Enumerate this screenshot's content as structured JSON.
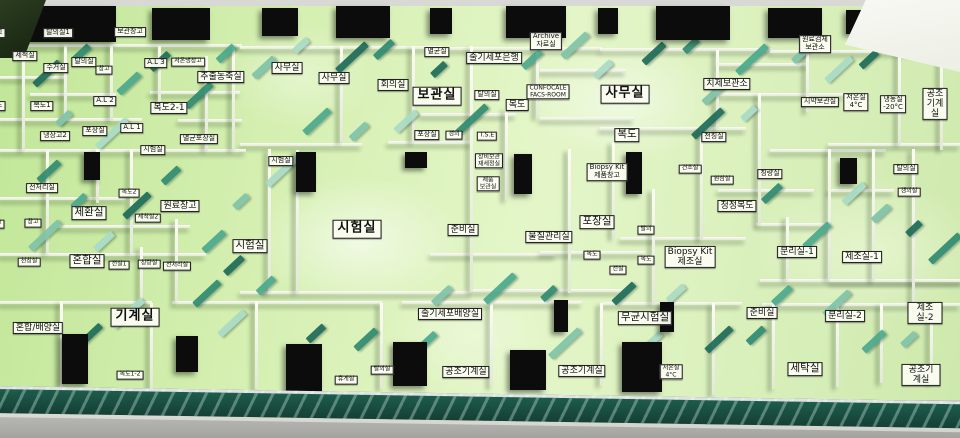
{
  "colors": {
    "floor_green": "#d6f1b2",
    "wall_white": "#f6f8ee",
    "accent_teal_dark": "#1d6b58",
    "accent_teal_light": "#aadbc6",
    "core_black": "#0c0c0c",
    "label_bg": "#f8fbee",
    "label_border": "#1b1b1b",
    "front_edge": "#17493d",
    "table_gray": "#b5b5b1"
  },
  "model": {
    "labels": [
      {
        "text": "탈의실1",
        "x": 58,
        "y": 33,
        "size": "sm"
      },
      {
        "text": "보관창고",
        "x": 130,
        "y": 32,
        "size": "sm"
      },
      {
        "text": "창고",
        "x": -4,
        "y": 33,
        "size": "sm"
      },
      {
        "text": "세척실",
        "x": 25,
        "y": 56,
        "size": "sm"
      },
      {
        "text": "수거실",
        "x": 56,
        "y": 68,
        "size": "sm"
      },
      {
        "text": "탈의실",
        "x": 84,
        "y": 62,
        "size": "sm"
      },
      {
        "text": "창고",
        "x": 104,
        "y": 70,
        "size": "xs"
      },
      {
        "text": "A.L 3",
        "x": 156,
        "y": 63,
        "size": "sm"
      },
      {
        "text": "저온냉장고",
        "x": 188,
        "y": 62,
        "size": "xs"
      },
      {
        "text": "추출농축실",
        "x": 221,
        "y": 77,
        "size": "md"
      },
      {
        "text": "복도1",
        "x": 42,
        "y": 106,
        "size": "sm"
      },
      {
        "text": "복도",
        "x": -4,
        "y": 106,
        "size": "sm"
      },
      {
        "text": "A.L 2",
        "x": 105,
        "y": 101,
        "size": "sm"
      },
      {
        "text": "복도2-1",
        "x": 169,
        "y": 108,
        "size": "md"
      },
      {
        "text": "냉장고2",
        "x": 55,
        "y": 136,
        "size": "sm"
      },
      {
        "text": "포장실",
        "x": 95,
        "y": 131,
        "size": "sm"
      },
      {
        "text": "A.L 1",
        "x": 132,
        "y": 128,
        "size": "sm"
      },
      {
        "text": "멸균포장실",
        "x": 199,
        "y": 139,
        "size": "sm"
      },
      {
        "text": "시험실",
        "x": 153,
        "y": 150,
        "size": "sm"
      },
      {
        "text": "전처리실",
        "x": 42,
        "y": 188,
        "size": "sm"
      },
      {
        "text": "복도2",
        "x": 129,
        "y": 193,
        "size": "xs"
      },
      {
        "text": "제환실",
        "x": 89,
        "y": 213,
        "size": "lg"
      },
      {
        "text": "원료창고",
        "x": 180,
        "y": 206,
        "size": "md"
      },
      {
        "text": "창고",
        "x": 33,
        "y": 223,
        "size": "xs"
      },
      {
        "text": "창고",
        "x": -4,
        "y": 224,
        "size": "xs"
      },
      {
        "text": "세척실2",
        "x": 148,
        "y": 218,
        "size": "xs"
      },
      {
        "text": "천칭실",
        "x": 29,
        "y": 262,
        "size": "xs"
      },
      {
        "text": "혼합실",
        "x": 87,
        "y": 261,
        "size": "lg"
      },
      {
        "text": "전실1",
        "x": 119,
        "y": 265,
        "size": "xs"
      },
      {
        "text": "칭량실",
        "x": 149,
        "y": 264,
        "size": "xs"
      },
      {
        "text": "전처리실",
        "x": 177,
        "y": 266,
        "size": "xs"
      },
      {
        "text": "혼합/배양실",
        "x": 38,
        "y": 328,
        "size": "md"
      },
      {
        "text": "기계실",
        "x": 135,
        "y": 317,
        "size": "xl"
      },
      {
        "text": "복도1-2",
        "x": 130,
        "y": 375,
        "size": "xs"
      },
      {
        "text": "시험실",
        "x": 281,
        "y": 161,
        "size": "sm"
      },
      {
        "text": "시험실",
        "x": 357,
        "y": 229,
        "size": "xl"
      },
      {
        "text": "시험실",
        "x": 250,
        "y": 246,
        "size": "lg"
      },
      {
        "text": "사무실",
        "x": 287,
        "y": 68,
        "size": "md"
      },
      {
        "text": "사무실",
        "x": 334,
        "y": 78,
        "size": "md"
      },
      {
        "text": "회의실",
        "x": 393,
        "y": 85,
        "size": "md"
      },
      {
        "text": "보관실",
        "x": 437,
        "y": 96,
        "size": "xl"
      },
      {
        "text": "멸균실",
        "x": 437,
        "y": 52,
        "size": "sm"
      },
      {
        "text": "포장실",
        "x": 427,
        "y": 135,
        "size": "sm"
      },
      {
        "text": "갱의",
        "x": 454,
        "y": 135,
        "size": "xs"
      },
      {
        "text": "T.S.E",
        "x": 487,
        "y": 136,
        "size": "xs"
      },
      {
        "text": "줄기세포은행",
        "x": 494,
        "y": 58,
        "size": "md"
      },
      {
        "text": "탈의실",
        "x": 487,
        "y": 95,
        "size": "sm"
      },
      {
        "text": "복도",
        "x": 517,
        "y": 105,
        "size": "md"
      },
      {
        "text": "장비보관\n재세정실",
        "x": 489,
        "y": 161,
        "size": "xs"
      },
      {
        "text": "제품\n보관실",
        "x": 488,
        "y": 184,
        "size": "xs"
      },
      {
        "text": "Archive\n자료실",
        "x": 546,
        "y": 41,
        "size": "sm"
      },
      {
        "text": "CONFOCALE\nFACS-ROOM",
        "x": 548,
        "y": 92,
        "size": "xs"
      },
      {
        "text": "사무실",
        "x": 625,
        "y": 94,
        "size": "xl"
      },
      {
        "text": "복도",
        "x": 627,
        "y": 135,
        "size": "lg"
      },
      {
        "text": "준비실",
        "x": 463,
        "y": 230,
        "size": "md"
      },
      {
        "text": "물질관리실",
        "x": 549,
        "y": 237,
        "size": "md"
      },
      {
        "text": "포장실",
        "x": 597,
        "y": 222,
        "size": "lg"
      },
      {
        "text": "Biopsy Kit\n제품창고",
        "x": 607,
        "y": 172,
        "size": "sm"
      },
      {
        "text": "복도",
        "x": 592,
        "y": 255,
        "size": "xs"
      },
      {
        "text": "전실",
        "x": 618,
        "y": 270,
        "size": "xs"
      },
      {
        "text": "줄기세포배양실",
        "x": 450,
        "y": 314,
        "size": "md"
      },
      {
        "text": "무균시험실",
        "x": 645,
        "y": 318,
        "size": "lg"
      },
      {
        "text": "공조기계실",
        "x": 466,
        "y": 372,
        "size": "md"
      },
      {
        "text": "공조기계실",
        "x": 582,
        "y": 371,
        "size": "md"
      },
      {
        "text": "저온실\n4°C",
        "x": 671,
        "y": 372,
        "size": "xs"
      },
      {
        "text": "휴게실",
        "x": 346,
        "y": 380,
        "size": "xs"
      },
      {
        "text": "탈의실",
        "x": 382,
        "y": 370,
        "size": "xs"
      },
      {
        "text": "치제보관소",
        "x": 727,
        "y": 84,
        "size": "md"
      },
      {
        "text": "원료검체\n보관소",
        "x": 815,
        "y": 44,
        "size": "sm"
      },
      {
        "text": "시약보관실",
        "x": 820,
        "y": 102,
        "size": "sm"
      },
      {
        "text": "저온실\n4°C",
        "x": 856,
        "y": 102,
        "size": "sm"
      },
      {
        "text": "냉동실\n-20°C",
        "x": 893,
        "y": 104,
        "size": "sm"
      },
      {
        "text": "공조기계실",
        "x": 935,
        "y": 104,
        "size": "md"
      },
      {
        "text": "천칭실",
        "x": 714,
        "y": 137,
        "size": "sm"
      },
      {
        "text": "건조실",
        "x": 690,
        "y": 169,
        "size": "xs"
      },
      {
        "text": "원심실",
        "x": 722,
        "y": 180,
        "size": "xs"
      },
      {
        "text": "칭량실",
        "x": 770,
        "y": 174,
        "size": "sm"
      },
      {
        "text": "청정복도",
        "x": 737,
        "y": 206,
        "size": "md"
      },
      {
        "text": "탈의",
        "x": 646,
        "y": 230,
        "size": "xs"
      },
      {
        "text": "복도",
        "x": 646,
        "y": 260,
        "size": "xs"
      },
      {
        "text": "Biopsy Kit\n제조실",
        "x": 690,
        "y": 257,
        "size": "md"
      },
      {
        "text": "분리실-1",
        "x": 797,
        "y": 252,
        "size": "md"
      },
      {
        "text": "제조실-1",
        "x": 862,
        "y": 257,
        "size": "md"
      },
      {
        "text": "탈의실",
        "x": 906,
        "y": 169,
        "size": "sm"
      },
      {
        "text": "갱의실",
        "x": 909,
        "y": 192,
        "size": "xs"
      },
      {
        "text": "준비실",
        "x": 762,
        "y": 313,
        "size": "md"
      },
      {
        "text": "분리실-2",
        "x": 845,
        "y": 316,
        "size": "md"
      },
      {
        "text": "제조실-2",
        "x": 925,
        "y": 313,
        "size": "md"
      },
      {
        "text": "세탁실",
        "x": 805,
        "y": 369,
        "size": "lg"
      },
      {
        "text": "공조기계실",
        "x": 921,
        "y": 375,
        "size": "md"
      }
    ]
  }
}
